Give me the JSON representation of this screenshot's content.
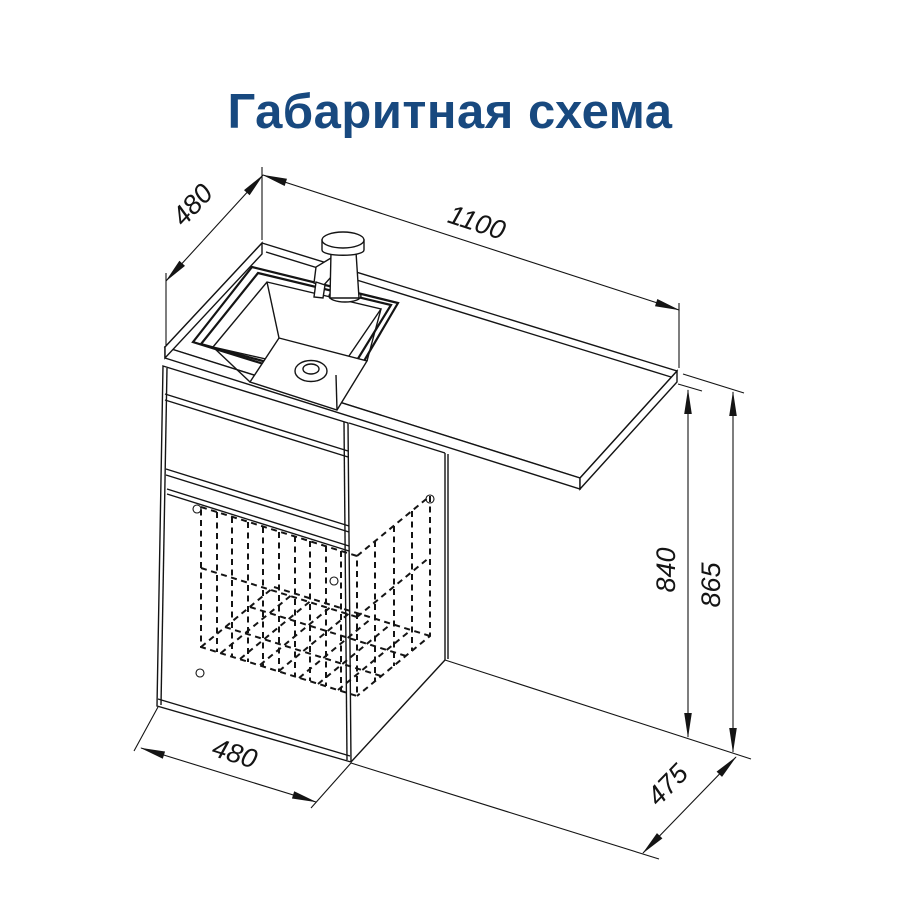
{
  "title": "Габаритная схема",
  "colors": {
    "title_blue": "#18497f",
    "line_black": "#141414",
    "background": "#ffffff"
  },
  "drawing": {
    "dimension_labels": {
      "countertop_depth": "480",
      "countertop_width": "1100",
      "underside_height": "840",
      "total_height": "865",
      "cabinet_width": "480",
      "floor_depth": "475"
    }
  }
}
